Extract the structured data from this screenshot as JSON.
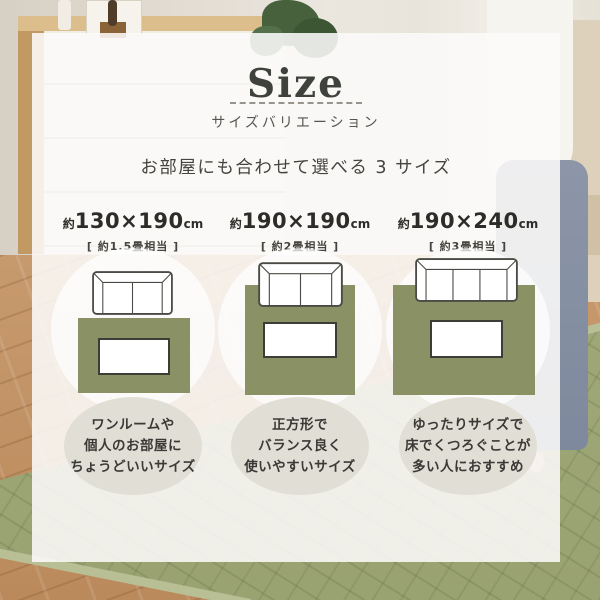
{
  "header": {
    "title": "Size",
    "subtitle": "サイズバリエーション",
    "tagline": "お部屋にも合わせて選べる 3 サイズ"
  },
  "sizes": [
    {
      "prefix": "約",
      "dimensions": "130×190",
      "unit": "cm",
      "tatami": "[ 約1.5畳相当 ]",
      "sofa_seats": 2,
      "description": [
        "ワンルームや",
        "個人のお部屋に",
        "ちょうどいいサイズ"
      ]
    },
    {
      "prefix": "約",
      "dimensions": "190×190",
      "unit": "cm",
      "tatami": "[ 約2畳相当 ]",
      "sofa_seats": 2,
      "description": [
        "正方形で",
        "バランス良く",
        "使いやすいサイズ"
      ]
    },
    {
      "prefix": "約",
      "dimensions": "190×240",
      "unit": "cm",
      "tatami": "[ 約3畳相当 ]",
      "sofa_seats": 3,
      "description": [
        "ゆったりサイズで",
        "床でくつろぐことが",
        "多い人におすすめ"
      ]
    }
  ],
  "colors": {
    "title_ink": "#3f423c",
    "rug_diagram_green": "#8a9164",
    "bubble_gray": "#e1ded6",
    "photo_rug_green": "#9fa877"
  }
}
